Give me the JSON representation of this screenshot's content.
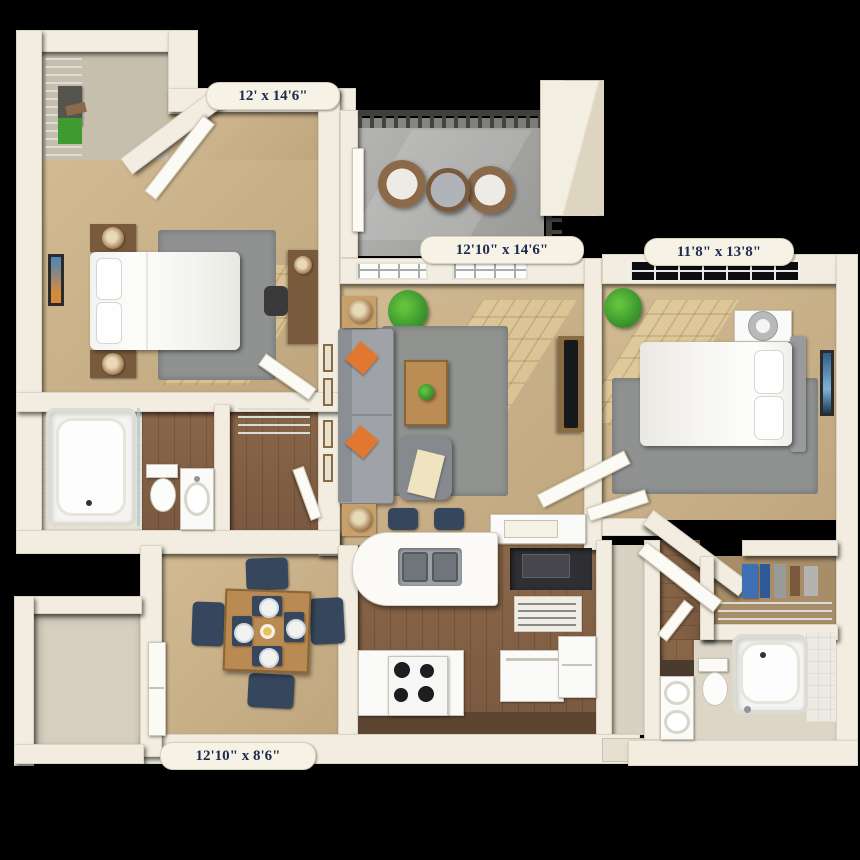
{
  "floorplan": {
    "type": "3d-apartment-floor-plan",
    "background": "#000000",
    "labels": {
      "bedroom1": "12' x 14'6\"",
      "living": "12'10\" x 14'6\"",
      "bedroom2": "11'8\" x 13'8\"",
      "dining": "12'10\" x 8'6\""
    },
    "rooms": [
      {
        "id": "bedroom-1",
        "dimensions": "12' x 14'6\""
      },
      {
        "id": "living-room",
        "dimensions": "12'10\" x 14'6\""
      },
      {
        "id": "bedroom-2",
        "dimensions": "11'8\" x 13'8\""
      },
      {
        "id": "dining-room",
        "dimensions": "12'10\" x 8'6\""
      },
      {
        "id": "balcony"
      },
      {
        "id": "kitchen"
      },
      {
        "id": "bathroom-1"
      },
      {
        "id": "bathroom-2"
      },
      {
        "id": "walk-in-closet-1"
      },
      {
        "id": "closet-2"
      },
      {
        "id": "storage"
      },
      {
        "id": "entry"
      }
    ],
    "furniture_icons": [
      "bed-icon",
      "pillow-icon",
      "nightstand-icon",
      "lamp-icon",
      "rug-icon",
      "artwork-icon",
      "sofa-icon",
      "accent-pillow-icon",
      "armchair-icon",
      "coffee-table-icon",
      "tv-icon",
      "tv-console-icon",
      "desk-icon",
      "dining-table-icon",
      "chair-icon",
      "plate-icon",
      "bar-stool-icon",
      "sink-icon",
      "stove-icon",
      "dishwasher-icon",
      "washer-icon",
      "microwave-icon",
      "pantry-shelf-icon",
      "tub-icon",
      "toilet-icon",
      "vanity-icon",
      "patio-chair-icon",
      "patio-table-icon",
      "railing-icon",
      "plant-icon",
      "wire-shelf-icon",
      "clothes-icon",
      "fan-icon",
      "door-icon",
      "window-icon"
    ],
    "colors": {
      "wall": "#f2ede0",
      "wall_edge": "#d8d0bb",
      "carpet": "#c9b18a",
      "wood_floor": "#84634a",
      "cabinet_dark": "#5c4431",
      "tile": "#e7e2d6",
      "balcony_concrete": "#a6a6a6",
      "rug": "#8f9290",
      "label_bg": "#f7f2e6",
      "label_text": "#1e2b4e",
      "accent_orange": "#e0792f",
      "plant_green": "#3f9b2f",
      "chair_navy": "#36465c",
      "tv_black": "#17181a",
      "window_dark": "#0d0d10",
      "railing": "#3f3f3b",
      "wicker": "#8a6a4a",
      "closet_blue": "#3f6fb5"
    }
  }
}
